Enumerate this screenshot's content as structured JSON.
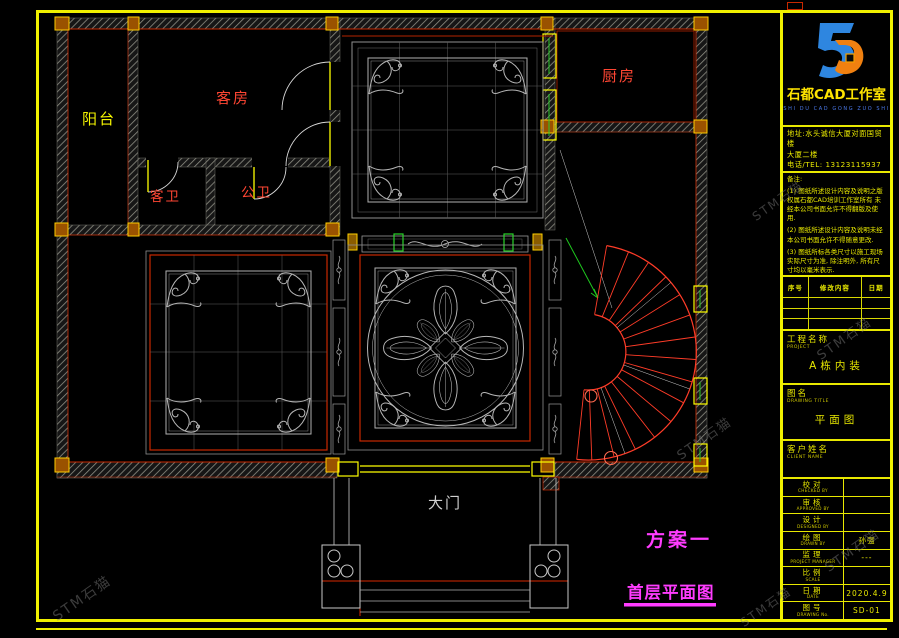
{
  "plan": {
    "labels": {
      "balcony": "阳台",
      "guest_room": "客房",
      "guest_bath": "客卫",
      "public_bath": "公卫",
      "kitchen": "厨房",
      "main_gate": "大门"
    },
    "scheme": "方案一",
    "caption": "首层平面图"
  },
  "title_block": {
    "studio": "石都CAD工作室",
    "pinyin": "SHI DU CAD GONG ZUO SHI",
    "address1": "地址:水头诚信大厦对面国贸楼",
    "address2": "大厦二楼",
    "phone": "电话/TEL: 13123115937",
    "notes_title": "备注:",
    "notes": [
      "(1) 图纸所述设计内容及说明之版权属石都CAD培训工作室所有 未经本公司书面允许不得翻版及使用.",
      "(2) 图纸所述设计内容及说明未经本公司书面允许不得随意更改.",
      "(3) 图纸所标各类尺寸以施工现场实际尺寸为准, 除注明外, 所有尺寸均以毫米表示."
    ],
    "revision": {
      "headers": [
        "序号",
        "修改内容",
        "日期"
      ]
    },
    "project": {
      "label": "工程名称",
      "en": "PROJECT",
      "value": "A栋内装"
    },
    "drawing": {
      "label": "图名",
      "en": "DRAWING TITLE",
      "value": "平面图"
    },
    "client": {
      "label": "客户姓名",
      "en": "CLIENT NAME",
      "value": ""
    },
    "rows": [
      {
        "label": "校对",
        "en": "CHECKED BY",
        "value": ""
      },
      {
        "label": "审核",
        "en": "APPROVED BY",
        "value": ""
      },
      {
        "label": "设计",
        "en": "DESIGNED BY",
        "value": ""
      },
      {
        "label": "绘图",
        "en": "DRAWN BY",
        "value": "孙强"
      },
      {
        "label": "监理",
        "en": "PROJECT MANAGER",
        "value": "---"
      },
      {
        "label": "比例",
        "en": "SCALE",
        "value": ""
      },
      {
        "label": "日期",
        "en": "DATE",
        "value": "2020.4.9"
      },
      {
        "label": "图号",
        "en": "DRAWING No.",
        "value": "SD-01"
      }
    ]
  },
  "watermark": {
    "text": "STM石猫"
  },
  "colors": {
    "frame": "#f0f000",
    "wall_red": "#c82800",
    "label_red": "#ff4633",
    "label_yellow": "#f5f500",
    "magenta": "#ff3cff",
    "logo_blue": "#2e86e0",
    "logo_orange": "#f08010"
  }
}
